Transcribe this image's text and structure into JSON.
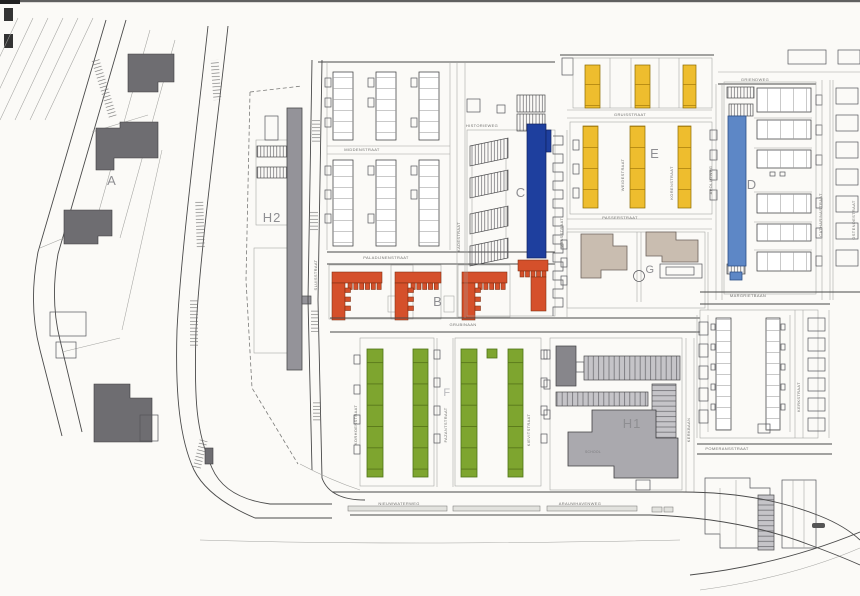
{
  "plan": {
    "blocks": {
      "a": "A",
      "b": "B",
      "c": "C",
      "d": "D",
      "e": "E",
      "f": "F",
      "g": "G",
      "h1": "H1",
      "h2": "H2"
    },
    "labels": {
      "school": "SCHOOL"
    },
    "streets": {
      "middenstraat": "MIDDENSTRAAT",
      "paladijnenstraat": "PALADIJNENSTRAAT",
      "grubinaan": "GRUBINAAN",
      "historieweg": "HISTORIEWEG",
      "gruisstraat": "GRUISSTRAAT",
      "passerstraat": "PASSERSTRAAT",
      "griendweg": "GRIENDWEG",
      "margrietbaan": "MARGRIETBAAN",
      "pomeransstraat": "POMERANSSTRAAT",
      "nieuwwaterweg": "NIEUWWATERWEG",
      "arauwhavenweg": "ARAUWHAVENWEG",
      "apolloweg": "APOLLOWEG",
      "catharinastraat": "CATHARINASTRAAT",
      "ostendestraat": "OSTENDESTRAAT",
      "maasstraat": "MAASSTRAAT",
      "kadestraat": "KADESTRAAT",
      "sluisstraat": "SLUISSTRAAT",
      "weidestraat": "WEIDESTRAAT",
      "korenstraat": "KORENSTRAAT",
      "fazantstraat": "FAZANTSTRAAT",
      "korhoenstraat": "KORHOENSTRAAT",
      "kievitstraat": "KIEVITSTRAAT",
      "kerkbaan": "KERKBAAN",
      "kerkstraat": "KERKSTRAAT"
    },
    "colors": {
      "paper": "#fbfaf7",
      "block_b_orange": "#d5502b",
      "block_c_blue": "#1e3f9e",
      "block_d_blue": "#5d87c6",
      "block_e_yellow": "#eebd2e",
      "block_f_green": "#7ea52f",
      "building_dark_gray": "#6e6d71",
      "building_mid_gray": "#949399",
      "building_light_gray": "#aaa9ae",
      "building_beige": "#c9bdb0",
      "label_gray": "#8e8e92",
      "label_faint": "#b9b9bd"
    }
  }
}
